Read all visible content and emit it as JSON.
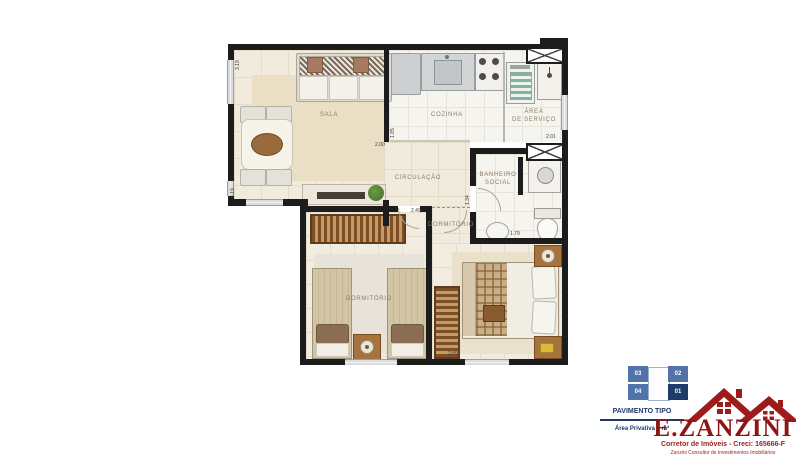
{
  "plan": {
    "rooms": {
      "sala": "SALA",
      "cozinha": "COZINHA",
      "area_servico_1": "ÁREA",
      "area_servico_2": "DE SERVIÇO",
      "circulacao": "CIRCULAÇÃO",
      "banheiro_1": "BANHEIRO",
      "banheiro_2": "SOCIAL",
      "dormitorio_casal": "DORMITÓRIO",
      "dormitorio_solteiro": "DORMITÓRIO"
    },
    "dimensions": {
      "sala_left_top": "3.19",
      "sala_left_bottom": "3.19",
      "parede_sala_cozinha": "1.85",
      "vao_sala": "2.00",
      "circulacao": "2.49",
      "entrada_dormitorio": "1.34",
      "banheiro": "1.79",
      "dormitorio": "2.89",
      "area_servico": "2.01"
    }
  },
  "keyplan": {
    "units": [
      "03",
      "02",
      "04",
      "01"
    ],
    "highlight": "01"
  },
  "branding": {
    "floor_label": "PAVIMENTO TIPO",
    "area_label": "Área Privativa = m²",
    "brand_name": "E.ZANZINI",
    "brand_line1": "Corretor de Imóveis - Creci: 165666-F",
    "brand_line2": "Zanzini Consultor de Investimentos Imobiliários"
  },
  "colors": {
    "wall": "#1c1c1c",
    "brand_red": "#9e1b1b",
    "navy": "#1e3a68",
    "keyplan_blue": "#5273aa",
    "keyplan_highlight": "#1e3a68",
    "floor_beige": "#f0ebdd"
  }
}
